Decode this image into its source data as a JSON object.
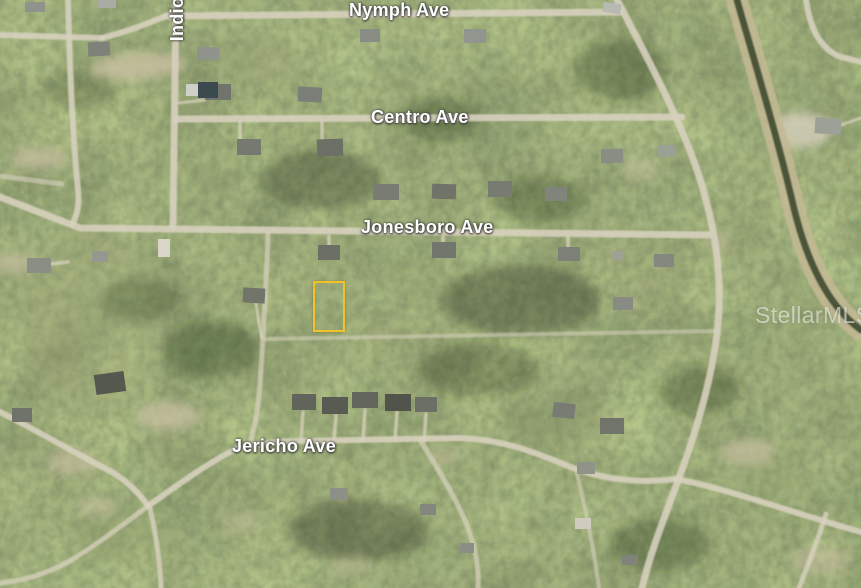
{
  "map": {
    "type": "aerial-satellite-listing-map",
    "street_labels": {
      "nymph": "Nymph Ave",
      "centro": "Centro Ave",
      "jonesboro": "Jonesboro Ave",
      "jericho": "Jericho Ave",
      "indio": "Indio"
    },
    "watermark": "StellarMLS",
    "parcel_highlight": {
      "color": "#F2C12E"
    },
    "colors": {
      "vegetation_base": "#5c6a49",
      "road": "#d8d2bf",
      "label_text": "#ffffff",
      "canal_bank": "#c3b994",
      "canal_water": "#3f4a30"
    }
  }
}
